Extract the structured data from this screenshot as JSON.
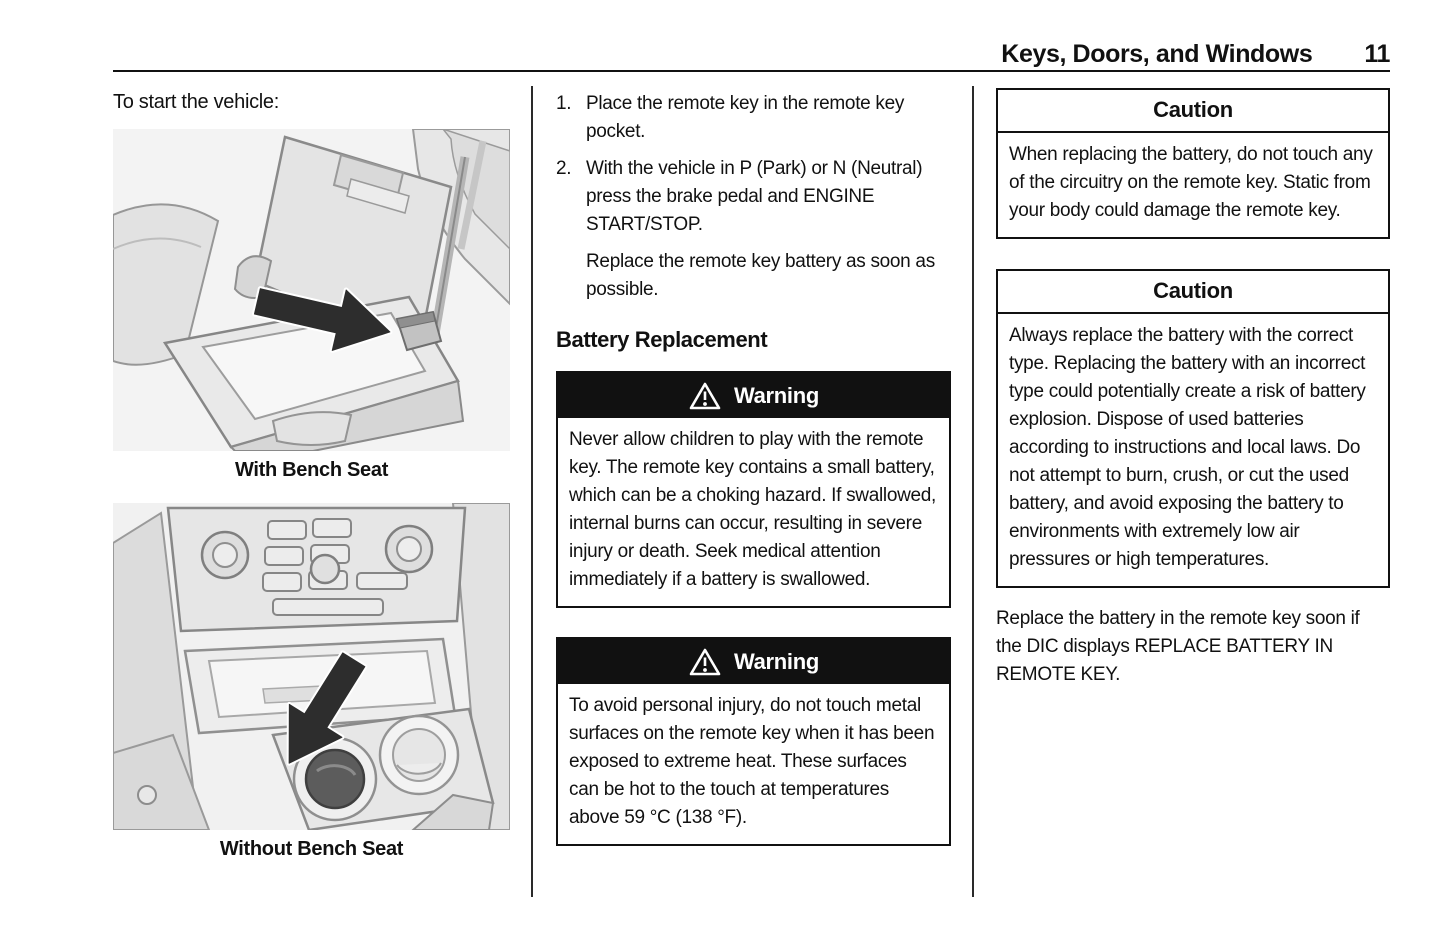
{
  "header": {
    "title": "Keys, Doors, and Windows",
    "page_number": "11"
  },
  "left_column": {
    "intro": "To start the vehicle:",
    "figures": [
      {
        "caption": "With Bench Seat"
      },
      {
        "caption": "Without Bench Seat"
      }
    ]
  },
  "middle_column": {
    "steps": [
      {
        "num": "1.",
        "text": "Place the remote key in the remote key pocket."
      },
      {
        "num": "2.",
        "text": "With the vehicle in P (Park) or N (Neutral) press the brake pedal and ENGINE START/STOP."
      }
    ],
    "step_note": "Replace the remote key battery as soon as possible.",
    "section_heading": "Battery Replacement",
    "warnings": [
      {
        "title": "Warning",
        "body": "Never allow children to play with the remote key. The remote key contains a small battery, which can be a choking hazard. If swallowed, internal burns can occur, resulting in severe injury or death. Seek medical attention immediately if a battery is swallowed."
      },
      {
        "title": "Warning",
        "body": "To avoid personal injury, do not touch metal surfaces on the remote key when it has been exposed to extreme heat. These surfaces can be hot to the touch at temperatures above 59 °C (138 °F)."
      }
    ]
  },
  "right_column": {
    "cautions": [
      {
        "title": "Caution",
        "body": "When replacing the battery, do not touch any of the circuitry on the remote key. Static from your body could damage the remote key."
      },
      {
        "title": "Caution",
        "body": "Always replace the battery with the correct type. Replacing the battery with an incorrect type could potentially create a risk of battery explosion. Dispose of used batteries according to instructions and local laws. Do not attempt to burn, crush, or cut the used battery, and avoid exposing the battery to environments with extremely low air pressures or high temperatures."
      }
    ],
    "closing_paragraph": "Replace the battery in the remote key soon if the DIC displays REPLACE BATTERY IN REMOTE KEY."
  },
  "colors": {
    "ink": "#111111",
    "paper": "#ffffff",
    "warning_header_bg": "#111111",
    "illustration_gray": "#e6e6e6"
  }
}
